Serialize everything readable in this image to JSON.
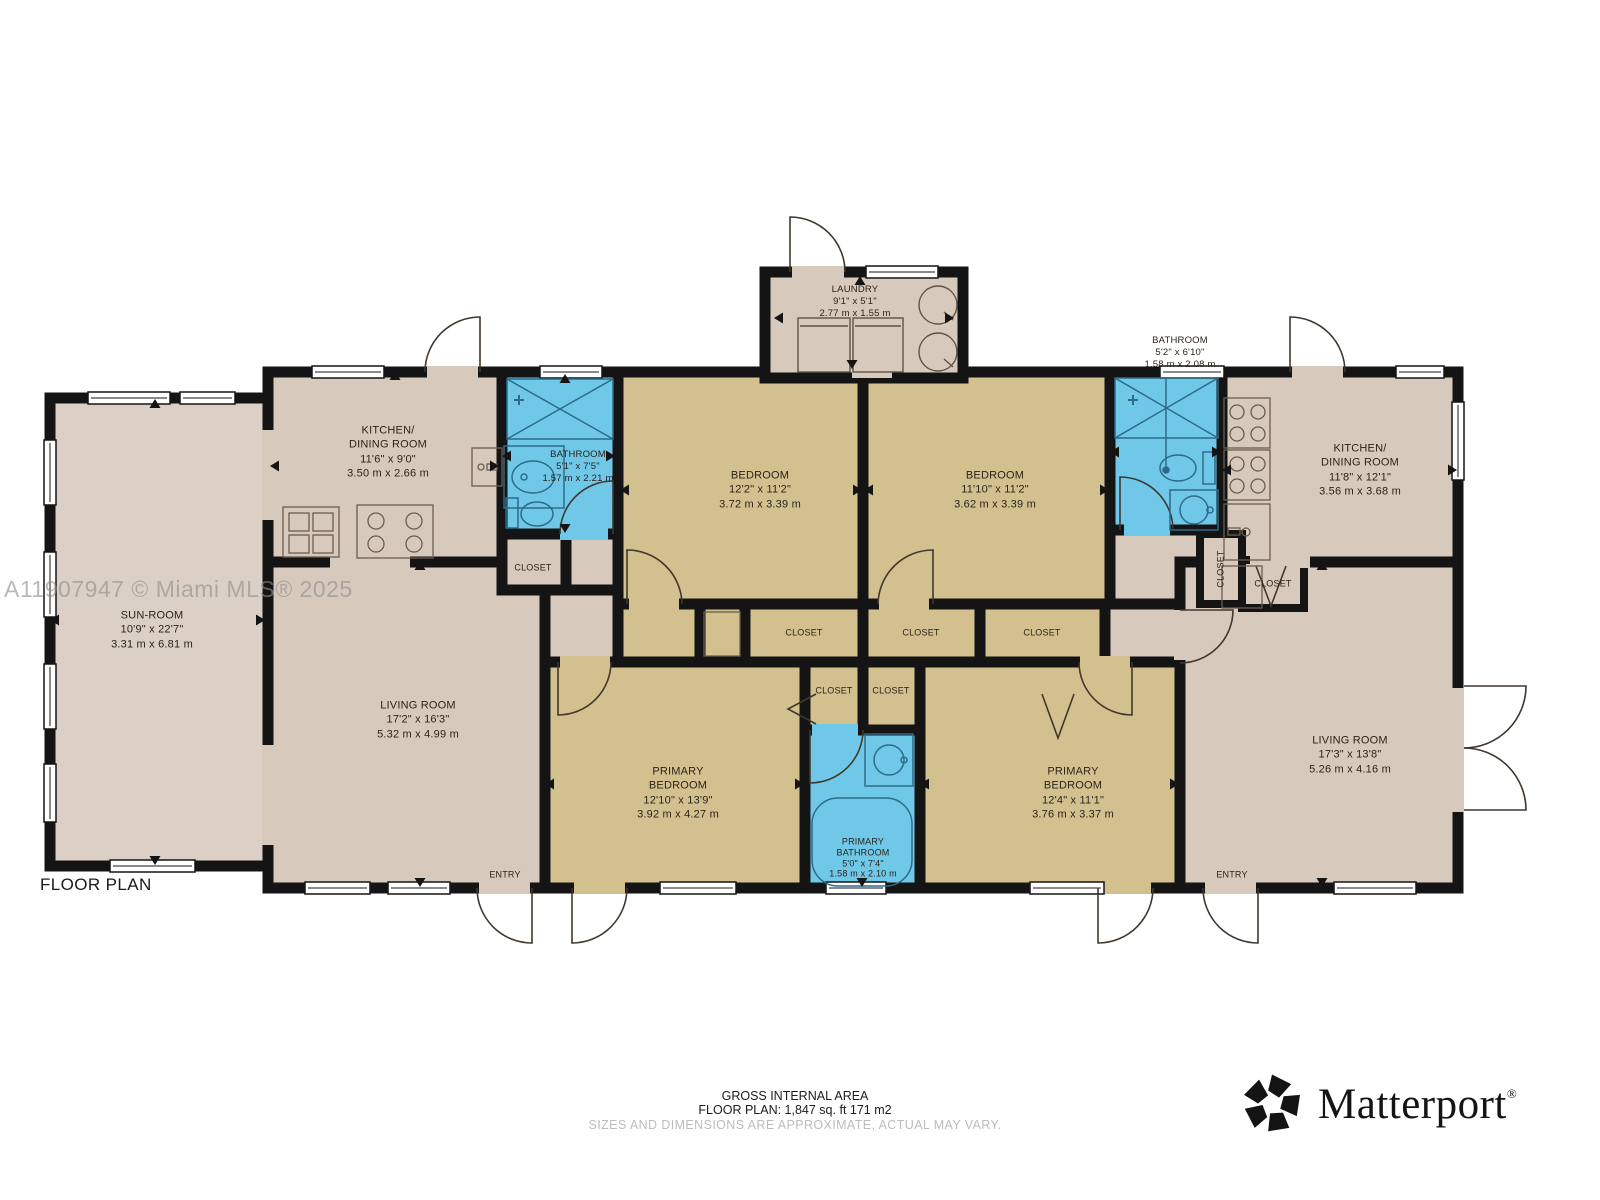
{
  "plan_title": "FLOOR PLAN",
  "watermark": "A11907947 © Miami MLS® 2025",
  "rooms": {
    "laundry": {
      "lines": [
        "LAUNDRY",
        "9'1\" x 5'1\"",
        "2.77 m x 1.55 m"
      ]
    },
    "kitchen_left": {
      "lines": [
        "KITCHEN/",
        "DINING ROOM",
        "11'6\" x 9'0\"",
        "3.50 m x 2.66 m"
      ]
    },
    "bathroom_left": {
      "lines": [
        "BATHROOM",
        "5'1\" x 7'5\"",
        "1.57 m x 2.21 m"
      ]
    },
    "bedroom_left": {
      "lines": [
        "BEDROOM",
        "12'2\" x 11'2\"",
        "3.72 m x 3.39 m"
      ]
    },
    "bedroom_right": {
      "lines": [
        "BEDROOM",
        "11'10\" x 11'2\"",
        "3.62 m x 3.39 m"
      ]
    },
    "bathroom_right": {
      "lines": [
        "BATHROOM",
        "5'2\" x 6'10\"",
        "1.58 m x 2.08 m"
      ]
    },
    "kitchen_right": {
      "lines": [
        "KITCHEN/",
        "DINING ROOM",
        "11'8\" x 12'1\"",
        "3.56 m x 3.68 m"
      ]
    },
    "sunroom": {
      "lines": [
        "SUN-ROOM",
        "10'9\" x 22'7\"",
        "3.31 m x 6.81 m"
      ]
    },
    "living_left": {
      "lines": [
        "LIVING ROOM",
        "17'2\" x 16'3\"",
        "5.32 m x 4.99 m"
      ]
    },
    "primary_bedroom_left": {
      "lines": [
        "PRIMARY",
        "BEDROOM",
        "12'10\" x 13'9\"",
        "3.92 m x 4.27 m"
      ]
    },
    "primary_bathroom": {
      "lines": [
        "PRIMARY",
        "BATHROOM",
        "5'0\" x 7'4\"",
        "1.58 m x 2.10 m"
      ]
    },
    "primary_bedroom_right": {
      "lines": [
        "PRIMARY",
        "BEDROOM",
        "12'4\" x 11'1\"",
        "3.76 m x 3.37 m"
      ]
    },
    "living_right": {
      "lines": [
        "LIVING ROOM",
        "17'3\" x 13'8\"",
        "5.26 m x 4.16 m"
      ]
    }
  },
  "labels": {
    "closet": "CLOSET",
    "entry": "ENTRY"
  },
  "footer": {
    "line1": "GROSS INTERNAL AREA",
    "line2": "FLOOR PLAN: 1,847 sq. ft 171 m2",
    "line3": "SIZES AND DIMENSIONS ARE APPROXIMATE, ACTUAL MAY VARY."
  },
  "brand": {
    "wordmark": "Matterport",
    "registered": "®"
  },
  "colors": {
    "wall": "#141414",
    "floor_beige": "#d7c9bc",
    "floor_tan": "#d2c08e",
    "bathroom_blue": "#6fc8e8",
    "sunroom_beige": "#dccfc5",
    "watermark_gray": "#8f8f8f",
    "footer_note_gray": "#bdbdbd"
  }
}
